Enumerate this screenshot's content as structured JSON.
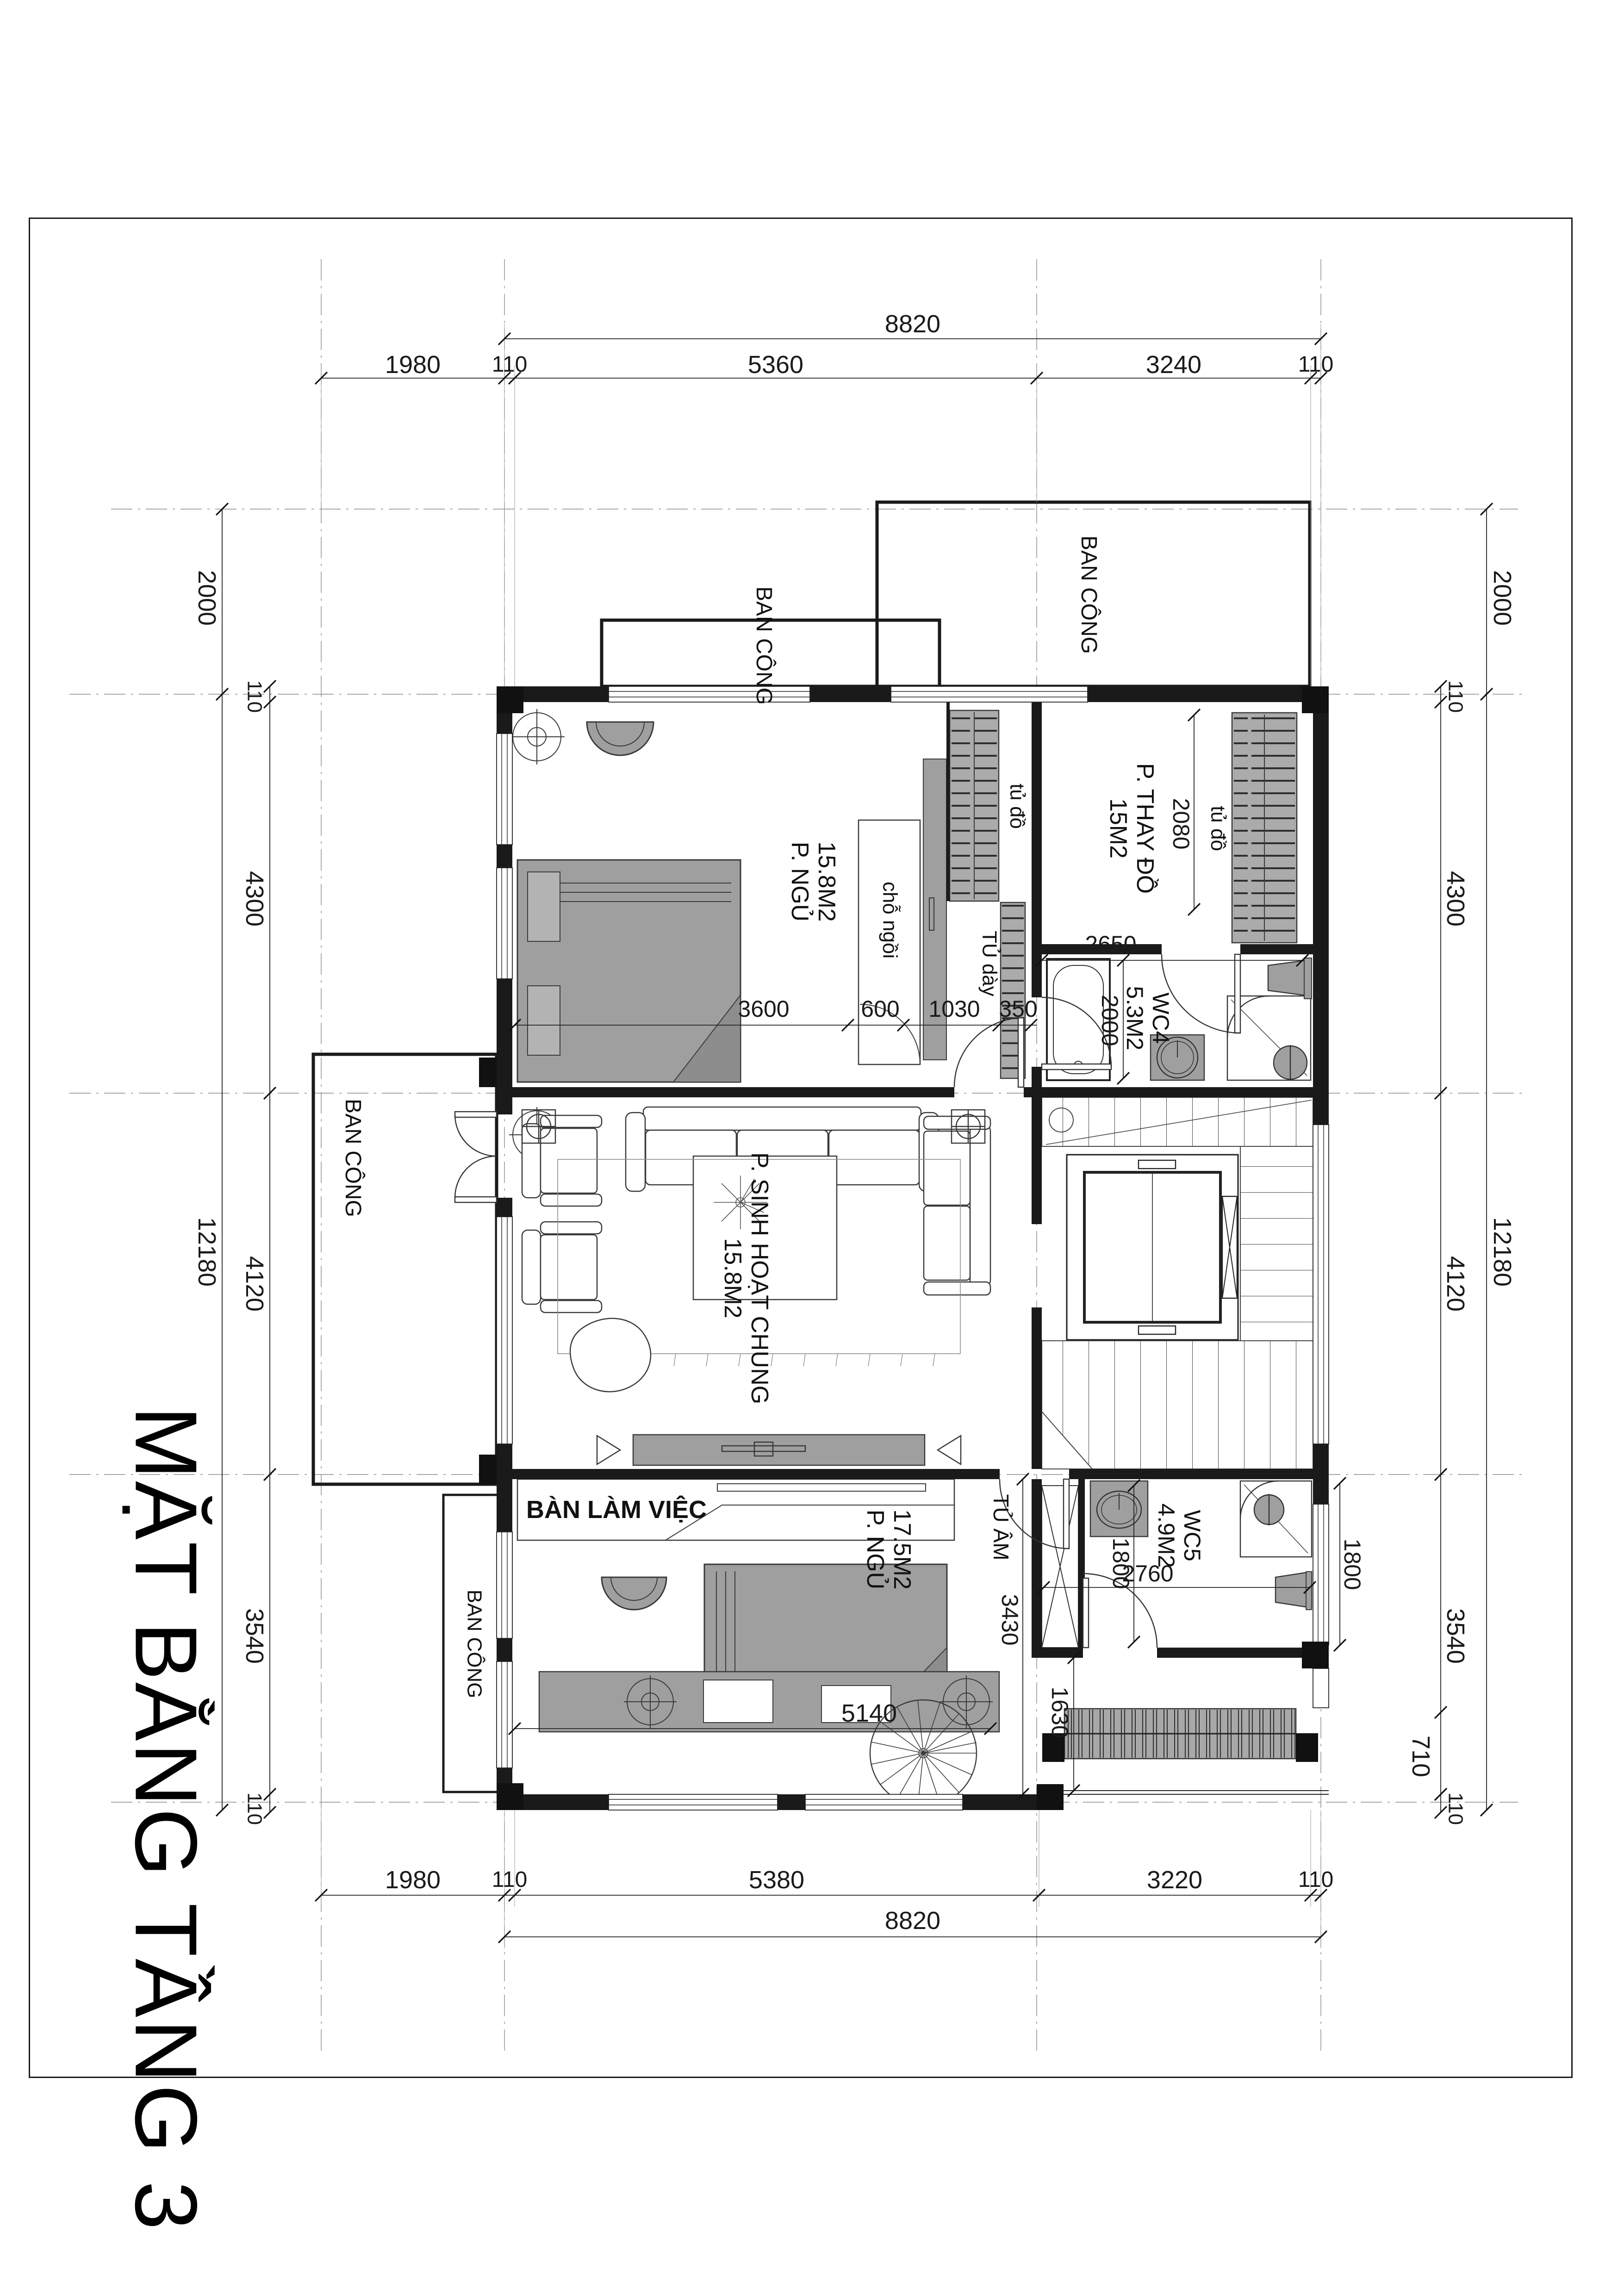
{
  "title": "MẶT BẰNG TẦNG 3",
  "rooms": {
    "bedroom_top": {
      "area": "15.8M2",
      "name": "P. NGỦ"
    },
    "dressing": {
      "name": "P. THAY ĐỒ",
      "area": "15M2"
    },
    "wc4": {
      "name": "WC4",
      "area": "5.3M2"
    },
    "living": {
      "name": "P. SINH HOẠT CHUNG",
      "area": "15.8M2"
    },
    "wc5": {
      "name": "WC5",
      "area": "4.9M2"
    },
    "bedroom_bottom": {
      "area": "17.5M2",
      "name": "P. NGỦ"
    }
  },
  "labels": {
    "balcony": "BAN CÔNG",
    "wardrobe": "tủ đồ",
    "seat": "chỗ ngồi",
    "cabinet_350": "TỦ dày",
    "built_in_cabinet": "TỦ ÂM",
    "desk": "BÀN LÀM VIỆC"
  },
  "dims": {
    "top_overall": "8820",
    "top": [
      "1980",
      "110",
      "5360",
      "3240",
      "110"
    ],
    "bottom": [
      "1980",
      "110",
      "5380",
      "3220",
      "110"
    ],
    "bottom_overall": "8820",
    "left_outer": [
      "2000",
      "12180"
    ],
    "left_inner": [
      "110",
      "4300",
      "4120",
      "3540",
      "110"
    ],
    "right_inner": [
      "110",
      "4300",
      "4120",
      "3540",
      "110"
    ],
    "right_outer": [
      "2000",
      "12180"
    ],
    "bedroom_top_row": [
      "3600",
      "600",
      "1030",
      "350"
    ],
    "wardrobe_depth": "2080",
    "wc4_width": "2650",
    "wc4_depth": "2000",
    "wc5_left": "1800",
    "wc5_right": "1800",
    "wc5_width": "2760",
    "void_depth": "1630",
    "bedroom_bottom_width": "5140",
    "bedroom_bottom_depth": "3430",
    "rail_offset": "710"
  }
}
